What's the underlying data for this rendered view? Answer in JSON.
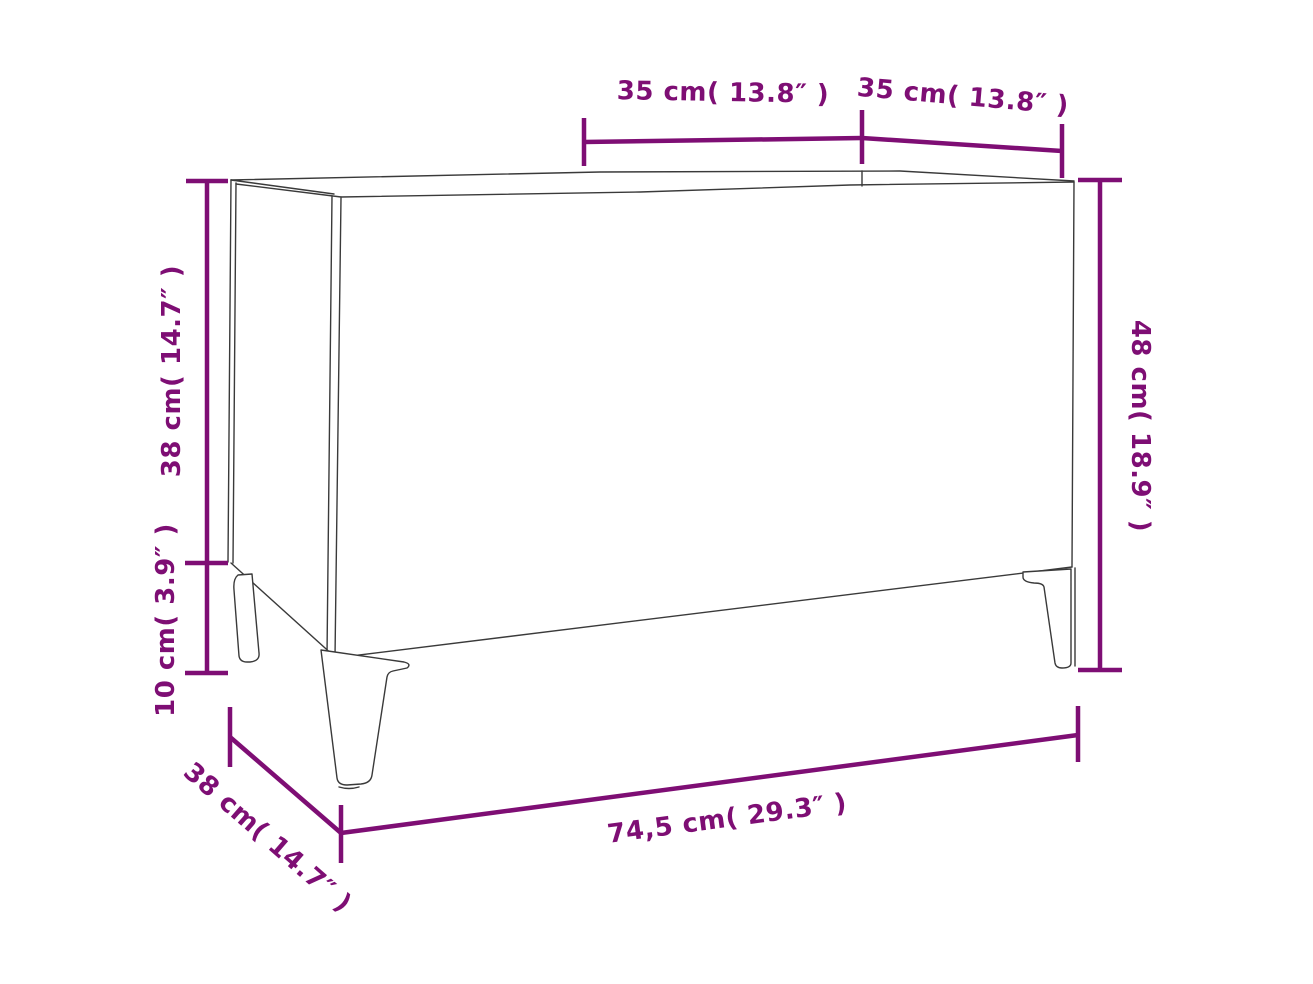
{
  "colors": {
    "accent": "#7E0E74",
    "outline": "#3a3a3a",
    "background": "#ffffff"
  },
  "diagram": {
    "subject": "record-cabinet-line-drawing",
    "labels": {
      "compartment_width_left": "35 cm( 13.8″ )",
      "compartment_width_right": "35 cm( 13.8″ )",
      "body_height": "38 cm( 14.7″ )",
      "leg_height": "10 cm( 3.9″ )",
      "overall_height": "48 cm( 18.9″ )",
      "overall_width": "74,5 cm( 29.3″ )",
      "depth": "38 cm( 14.7″ )"
    }
  }
}
